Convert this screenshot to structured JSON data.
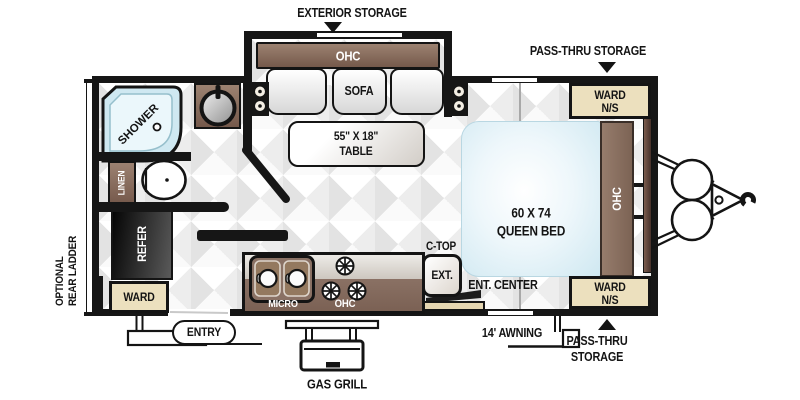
{
  "colors": {
    "wall": "#161616",
    "cabinet_brown": "#8a7164",
    "ward_cream": "#ece0be",
    "fixture_blue": "#cfe8f1",
    "front_wall_brown": "#6b4f43",
    "cabinet_tan": "#e5d6b1"
  },
  "exterior": {
    "exterior_storage": "EXTERIOR STORAGE",
    "pass_thru_storage_top": "PASS-THRU STORAGE",
    "pass_thru_bottom_line1": "PASS-THRU",
    "pass_thru_bottom_line2": "STORAGE",
    "awning": "14' AWNING",
    "gas_grill": "GAS GRILL",
    "entry": "ENTRY",
    "ladder_line1": "OPTIONAL",
    "ladder_line2": "REAR LADDER"
  },
  "living": {
    "ohc_slide": "OHC",
    "sofa": "SOFA",
    "table_line1": "55\" X 18\"",
    "table_line2": "TABLE",
    "ent_center": "ENT. CENTER"
  },
  "kitchen": {
    "micro": "MICRO",
    "ohc": "OHC",
    "ctop_line1": "C-TOP",
    "ctop_line2": "EXT.",
    "refer": "REFER",
    "ward_rear": "WARD"
  },
  "bath": {
    "shower": "SHOWER",
    "linen": "LINEN"
  },
  "bedroom": {
    "bed_line1": "60 X 74",
    "bed_line2": "QUEEN BED",
    "ohc_front": "OHC",
    "ward_top_line1": "WARD",
    "ward_top_line2": "N/S",
    "ward_bottom_line1": "WARD",
    "ward_bottom_line2": "N/S"
  }
}
